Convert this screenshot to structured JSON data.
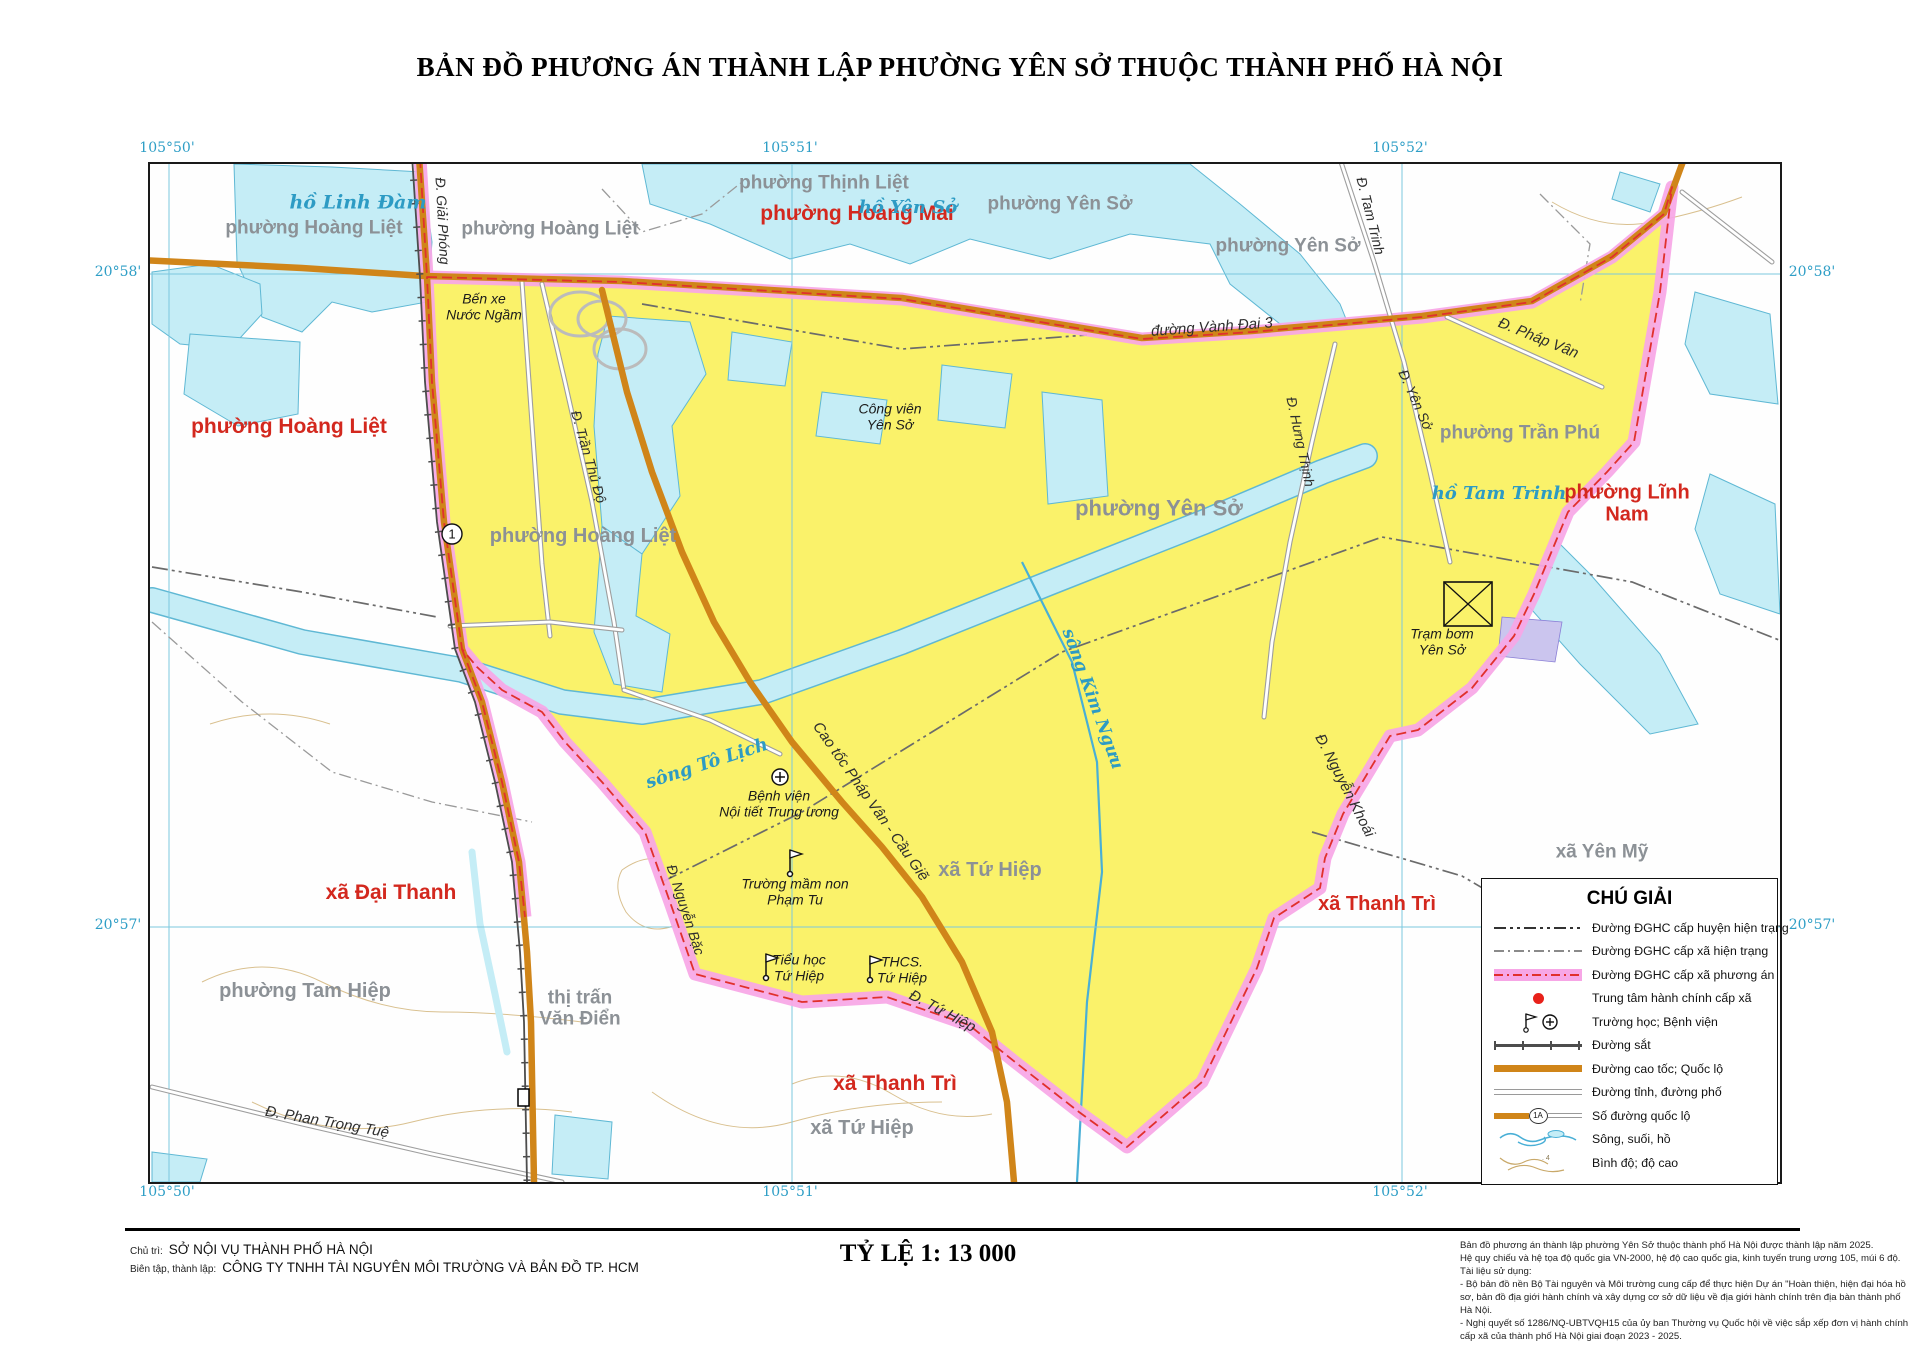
{
  "title": "BẢN ĐỒ PHƯƠNG ÁN THÀNH LẬP PHƯỜNG YÊN SỞ THUỘC THÀNH PHỐ HÀ NỘI",
  "colors": {
    "proposed_area_fill": "#FAF26A",
    "proposed_boundary_band": "#F7A6E6",
    "boundary_dash_red": "#E0302C",
    "water_fill": "#C5EDF6",
    "highway_orange": "#D08519",
    "adjacent_unit_red": "#D3281E",
    "current_unit_gray": "#8C9196"
  },
  "graticule_labels": [
    {
      "text": "105°50'",
      "x": 167,
      "y": 148
    },
    {
      "text": "105°51'",
      "x": 790,
      "y": 148
    },
    {
      "text": "105°52'",
      "x": 1400,
      "y": 148
    },
    {
      "text": "105°50'",
      "x": 167,
      "y": 1192
    },
    {
      "text": "105°51'",
      "x": 790,
      "y": 1192
    },
    {
      "text": "105°52'",
      "x": 1400,
      "y": 1192
    },
    {
      "text": "20°58'",
      "x": 118,
      "y": 272
    },
    {
      "text": "20°57'",
      "x": 118,
      "y": 925
    },
    {
      "text": "20°58'",
      "x": 1812,
      "y": 272
    },
    {
      "text": "20°57'",
      "x": 1812,
      "y": 925
    }
  ],
  "map": {
    "route_badge": "1",
    "labels": [
      {
        "n": "label-phuong-hoang-mai",
        "t": "phường Hoàng Mai",
        "x": 707,
        "y": 50,
        "c": "adm-red",
        "s": 21
      },
      {
        "n": "label-phuong-hoang-liet-west",
        "t": "phường Hoàng Liệt",
        "x": 139,
        "y": 263,
        "c": "adm-red",
        "s": 21
      },
      {
        "n": "label-phuong-linh-nam",
        "t": "phường Lĩnh Nam",
        "x": 1477,
        "y": 340,
        "c": "adm-red",
        "s": 20
      },
      {
        "n": "label-xa-dai-thanh",
        "t": "xã Đại Thanh",
        "x": 241,
        "y": 729,
        "c": "adm-red",
        "s": 21
      },
      {
        "n": "label-xa-thanh-tri-south",
        "t": "xã Thanh Trì",
        "x": 745,
        "y": 920,
        "c": "adm-red",
        "s": 21
      },
      {
        "n": "label-xa-thanh-tri-east",
        "t": "xã Thanh Trì",
        "x": 1227,
        "y": 740,
        "c": "adm-red",
        "s": 20
      },
      {
        "n": "label-phuong-hoang-liet-nw1",
        "t": "phường Hoàng Liệt",
        "x": 164,
        "y": 64,
        "c": "adm-gray",
        "s": 19
      },
      {
        "n": "label-phuong-hoang-liet-nw2",
        "t": "phường Hoàng Liệt",
        "x": 400,
        "y": 65,
        "c": "adm-gray",
        "s": 19
      },
      {
        "n": "label-phuong-thinh-liet",
        "t": "phường Thịnh Liệt",
        "x": 674,
        "y": 19,
        "c": "adm-gray",
        "s": 19
      },
      {
        "n": "label-phuong-yen-so-north",
        "t": "phường Yên Sở",
        "x": 910,
        "y": 40,
        "c": "adm-gray",
        "s": 19
      },
      {
        "n": "label-phuong-yen-so-ne",
        "t": "phường Yên Sở",
        "x": 1138,
        "y": 82,
        "c": "adm-gray",
        "s": 19
      },
      {
        "n": "label-phuong-tran-phu",
        "t": "phường Trần Phú",
        "x": 1370,
        "y": 269,
        "c": "adm-gray",
        "s": 19
      },
      {
        "n": "label-phuong-hoang-liet-inside",
        "t": "phường Hoàng Liệt",
        "x": 433,
        "y": 372,
        "c": "adm-gray",
        "s": 20
      },
      {
        "n": "label-phuong-yen-so-inside",
        "t": "phường Yên Sở",
        "x": 1009,
        "y": 345,
        "c": "adm-gray",
        "s": 22
      },
      {
        "n": "label-xa-tu-hiep-inside",
        "t": "xã Tứ Hiệp",
        "x": 840,
        "y": 706,
        "c": "adm-gray",
        "s": 20
      },
      {
        "n": "label-xa-tu-hiep-south",
        "t": "xã Tứ Hiệp",
        "x": 712,
        "y": 964,
        "c": "adm-gray",
        "s": 20
      },
      {
        "n": "label-phuong-tam-hiep",
        "t": "phường Tam Hiệp",
        "x": 155,
        "y": 827,
        "c": "adm-gray",
        "s": 20
      },
      {
        "n": "label-thi-tran-van-dien",
        "t": "thị trấn\nVăn Điển",
        "x": 430,
        "y": 845,
        "c": "adm-gray",
        "s": 19
      },
      {
        "n": "label-xa-yen-my",
        "t": "xã Yên Mỹ",
        "x": 1452,
        "y": 688,
        "c": "adm-gray",
        "s": 19
      },
      {
        "n": "label-ho-linh-dam",
        "t": "hồ Linh Đàm",
        "x": 208,
        "y": 39,
        "c": "water-lbl",
        "s": 19
      },
      {
        "n": "label-ho-yen-so",
        "t": "hồ Yên Sở",
        "x": 758,
        "y": 44,
        "c": "water-lbl",
        "s": 18
      },
      {
        "n": "label-ho-tam-trinh",
        "t": "hồ Tam Trinh",
        "x": 1349,
        "y": 330,
        "c": "water-lbl",
        "s": 18
      },
      {
        "n": "label-song-to-lich",
        "t": "sông Tô Lịch",
        "x": 557,
        "y": 600,
        "c": "water-lbl",
        "s": 18,
        "r": -18
      },
      {
        "n": "label-song-kim-nguu",
        "t": "sông Kim Ngưu",
        "x": 942,
        "y": 535,
        "c": "water-lbl",
        "s": 17,
        "r": 70
      },
      {
        "n": "label-ben-xe-nuoc-ngam",
        "t": "Bến xe\nNước Ngầm",
        "x": 334,
        "y": 143,
        "c": "poi",
        "s": 14
      },
      {
        "n": "label-cong-vien-yen-so",
        "t": "Công viên\nYên Sở",
        "x": 740,
        "y": 253,
        "c": "poi",
        "s": 14
      },
      {
        "n": "label-tram-bom-yen-so",
        "t": "Trạm bơm\nYên Sở",
        "x": 1292,
        "y": 478,
        "c": "poi",
        "s": 14
      },
      {
        "n": "label-benh-vien-noi-tiet",
        "t": "Bệnh viện\nNội tiết Trung ương",
        "x": 629,
        "y": 640,
        "c": "poi",
        "s": 14
      },
      {
        "n": "label-truong-mam-non-pham-tu",
        "t": "Trường mầm non\nPhạm Tu",
        "x": 645,
        "y": 728,
        "c": "poi",
        "s": 14
      },
      {
        "n": "label-tieu-hoc-tu-hiep",
        "t": "Tiểu học\nTứ Hiệp",
        "x": 649,
        "y": 804,
        "c": "poi",
        "s": 14
      },
      {
        "n": "label-thcs-tu-hiep",
        "t": "THCS.\nTứ Hiệp",
        "x": 752,
        "y": 806,
        "c": "poi",
        "s": 14
      },
      {
        "n": "label-d-giai-phong",
        "t": "Đ. Giải Phóng",
        "x": 292,
        "y": 57,
        "c": "road-lbl",
        "s": 14,
        "r": 87
      },
      {
        "n": "label-d-tran-thu-do",
        "t": "Đ. Trần Thủ Độ",
        "x": 438,
        "y": 293,
        "c": "road-lbl",
        "s": 14,
        "r": 74
      },
      {
        "n": "label-duong-vanh-dai-3",
        "t": "đường Vành Đai 3",
        "x": 1062,
        "y": 164,
        "c": "road-lbl",
        "s": 15,
        "r": -4
      },
      {
        "n": "label-d-phap-van",
        "t": "Đ. Pháp Vân",
        "x": 1388,
        "y": 175,
        "c": "road-lbl",
        "s": 15,
        "r": 22
      },
      {
        "n": "label-d-tam-trinh",
        "t": "Đ. Tam Trinh",
        "x": 1220,
        "y": 52,
        "c": "road-lbl",
        "s": 14,
        "r": 76
      },
      {
        "n": "label-d-yen-so",
        "t": "Đ. Yên Sở",
        "x": 1265,
        "y": 236,
        "c": "road-lbl",
        "s": 14,
        "r": 66
      },
      {
        "n": "label-d-hung-thinh",
        "t": "Đ. Hưng Thịnh",
        "x": 1150,
        "y": 278,
        "c": "road-lbl",
        "s": 14,
        "r": 78
      },
      {
        "n": "label-d-nguyen-khoai",
        "t": "Đ. Nguyễn Khoái",
        "x": 1194,
        "y": 622,
        "c": "road-lbl",
        "s": 15,
        "r": 63
      },
      {
        "n": "label-cao-toc-phap-van-cau-gie",
        "t": "Cao tốc Pháp Vân - Cầu Giẽ",
        "x": 720,
        "y": 638,
        "c": "road-lbl",
        "s": 15,
        "r": 55
      },
      {
        "n": "label-d-nguyen-bac",
        "t": "Đ. Nguyễn Bặc",
        "x": 535,
        "y": 746,
        "c": "road-lbl",
        "s": 14,
        "r": 72
      },
      {
        "n": "label-d-tu-hiep",
        "t": "Đ. Tứ Hiệp",
        "x": 792,
        "y": 848,
        "c": "road-lbl",
        "s": 15,
        "r": 28
      },
      {
        "n": "label-d-phan-trong-tue",
        "t": "Đ. Phan Trọng Tuệ",
        "x": 177,
        "y": 959,
        "c": "road-lbl",
        "s": 15,
        "r": 10
      }
    ]
  },
  "legend": {
    "title": "CHÚ GIẢI",
    "items": [
      {
        "symbol": "boundary-district",
        "label": "Đường ĐGHC cấp huyện hiện trạng"
      },
      {
        "symbol": "boundary-commune",
        "label": "Đường ĐGHC cấp xã hiện trạng"
      },
      {
        "symbol": "boundary-proposed",
        "label": "Đường ĐGHC cấp xã phương án"
      },
      {
        "symbol": "admin-center",
        "label": "Trung tâm hành chính cấp xã"
      },
      {
        "symbol": "school-hospital",
        "label": "Trường học; Bệnh viện"
      },
      {
        "symbol": "railway",
        "label": "Đường sắt"
      },
      {
        "symbol": "expressway",
        "label": "Đường cao tốc; Quốc lộ"
      },
      {
        "symbol": "street",
        "label": "Đường tỉnh, đường phố"
      },
      {
        "symbol": "route-number",
        "label": "Số đường quốc lộ",
        "badge": "1A"
      },
      {
        "symbol": "river",
        "label": "Sông, suối, hồ"
      },
      {
        "symbol": "contour",
        "label": "Bình độ; độ cao"
      }
    ]
  },
  "footer": {
    "credits": [
      {
        "label": "Chủ trì:",
        "value": "SỞ NỘI VỤ THÀNH PHỐ HÀ NỘI"
      },
      {
        "label": "Biên tập, thành lập:",
        "value": "CÔNG TY TNHH TÀI NGUYÊN MÔI TRƯỜNG VÀ BẢN ĐỒ TP. HCM"
      }
    ],
    "scale": "TỶ LỆ 1: 13 000",
    "notes": [
      "Bản đồ phương án thành lập phường Yên Sở thuộc thành phố Hà Nội được thành lập năm 2025.",
      "Hệ quy chiếu và hệ tọa độ quốc gia VN-2000, hệ độ cao quốc gia, kinh tuyến trung ương 105, múi 6 độ.",
      "Tài liệu sử dụng:",
      "- Bộ bản đồ nền Bộ Tài nguyên và Môi trường cung cấp để thực hiện Dự án \"Hoàn thiện, hiện đại hóa hồ sơ, bản đồ địa giới hành chính và xây dựng cơ sở dữ liệu về địa giới hành chính trên địa bàn thành phố Hà Nội.",
      "- Nghị quyết số 1286/NQ-UBTVQH15 của ủy ban Thường vụ Quốc hội về việc sắp xếp đơn vị hành chính cấp xã của thành phố Hà Nội giai đoạn 2023 - 2025."
    ]
  }
}
